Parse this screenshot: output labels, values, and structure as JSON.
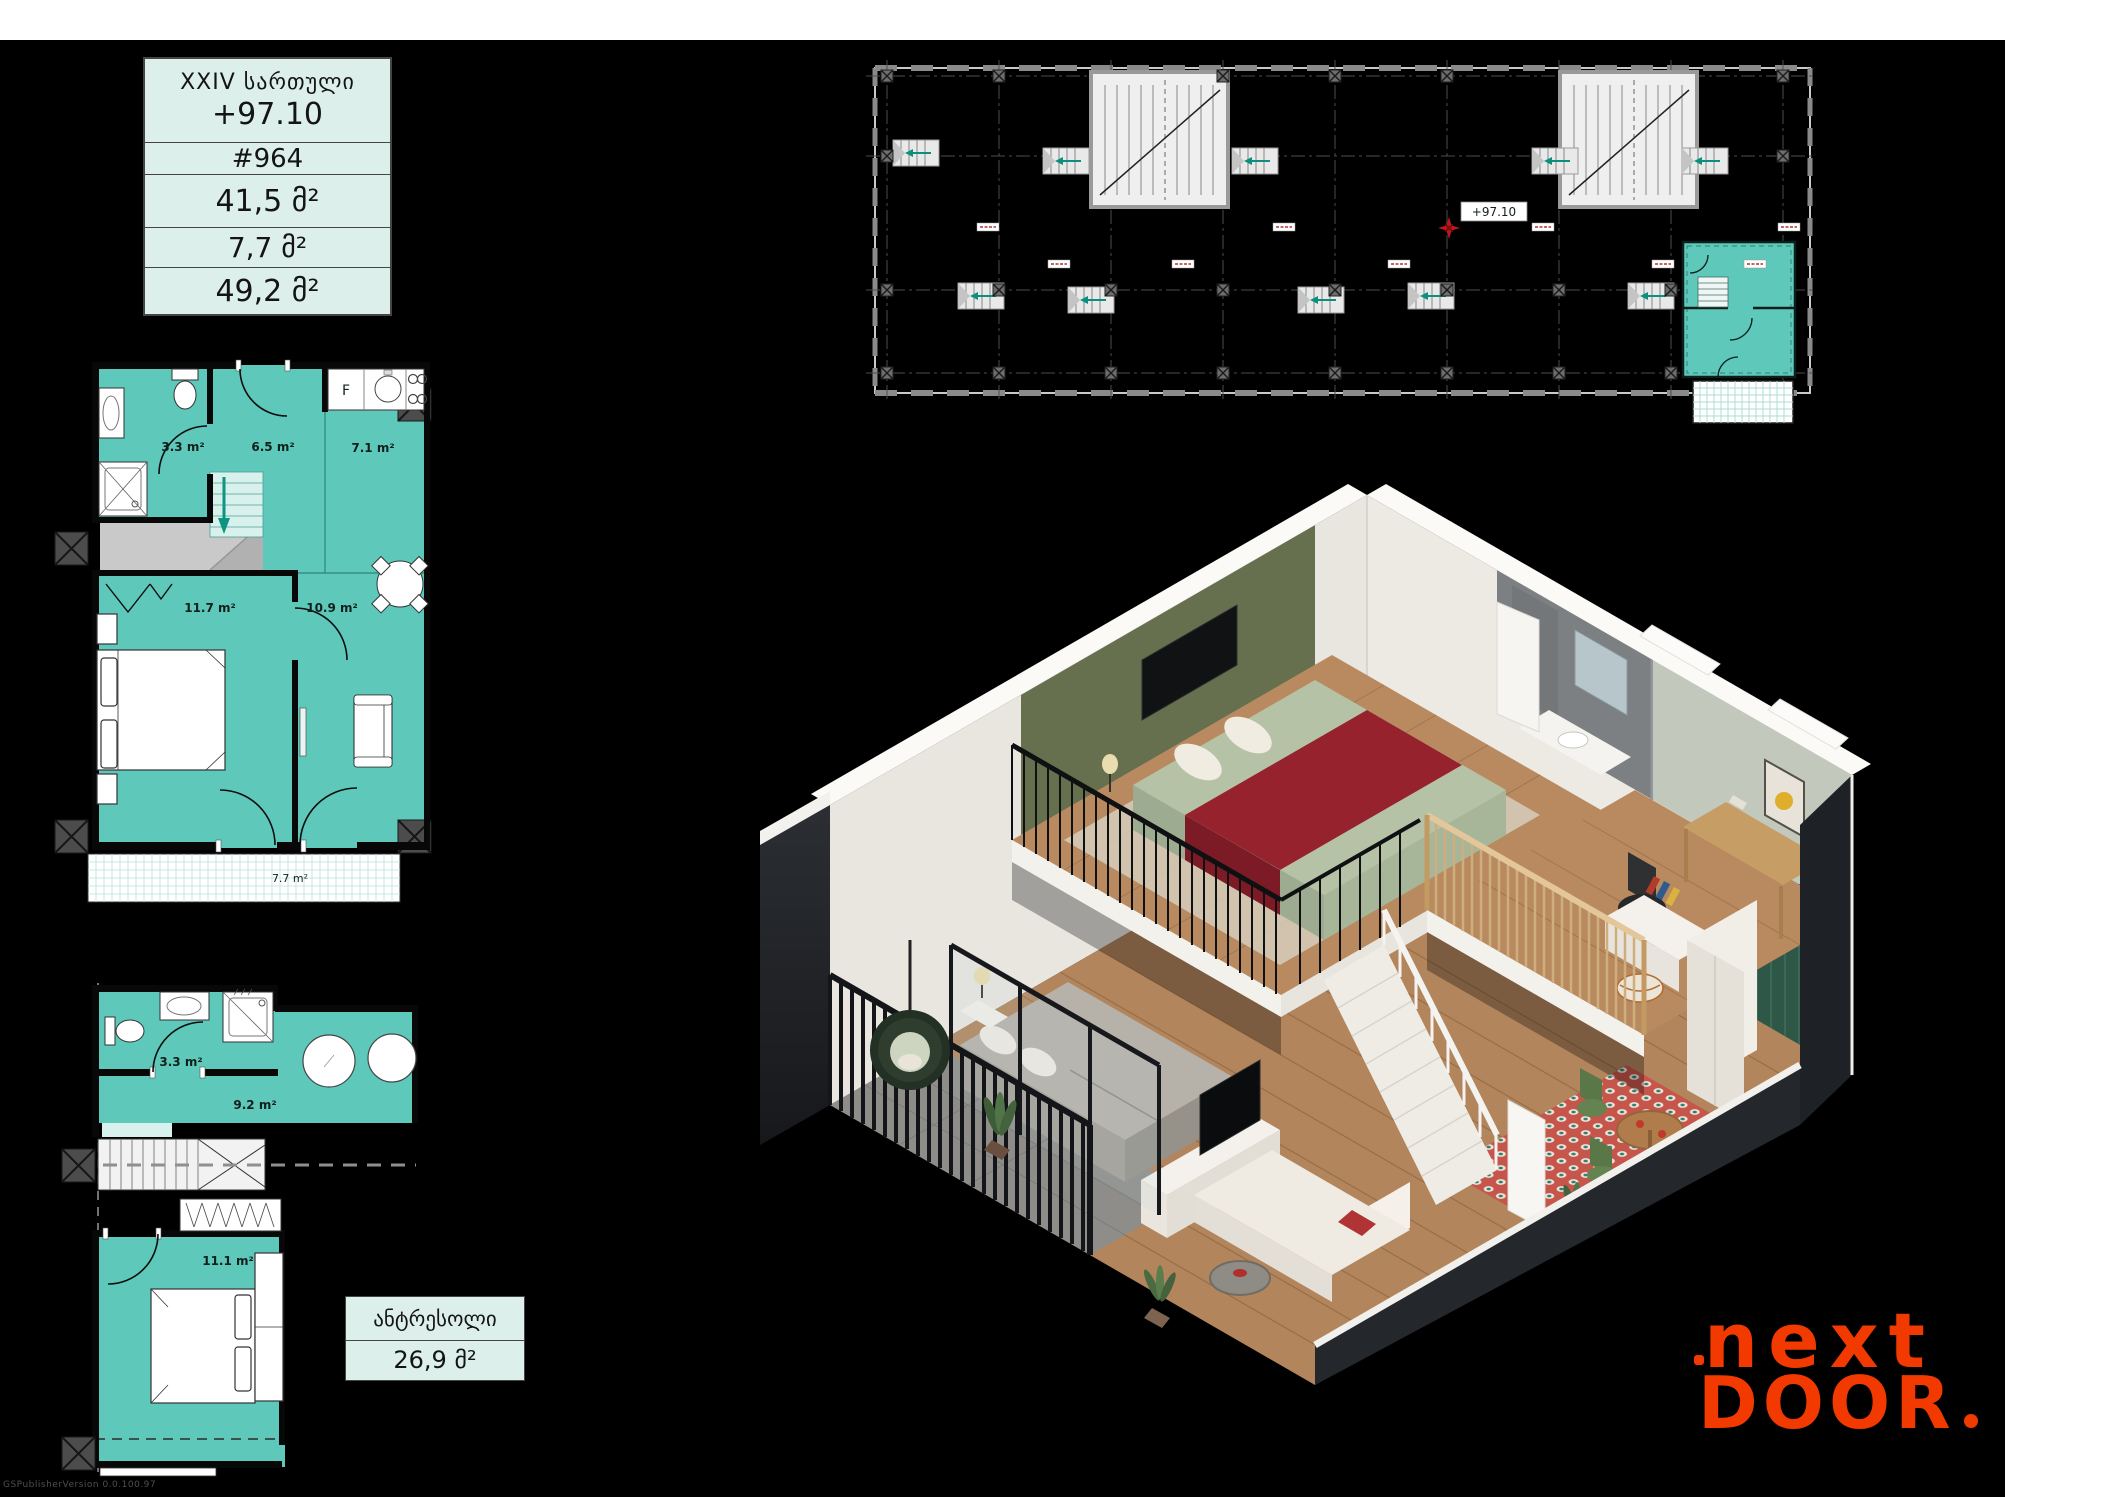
{
  "info_table": {
    "floor_label": "XXIV სართული",
    "elevation": "+97.10",
    "unit_number": "#964",
    "area_main": "41,5 მ²",
    "area_balcony": "7,7 მ²",
    "area_total": "49,2 მ²"
  },
  "key_plan": {
    "marker_label": "+97.10"
  },
  "upper_plan": {
    "rooms": {
      "bathroom": "3.3 m²",
      "hall": "6.5 m²",
      "kitchen": "7.1 m²",
      "bedroom": "11.7 m²",
      "living": "10.9 m²",
      "balcony": "7.7 m²"
    },
    "fridge_label": "F"
  },
  "lower_plan": {
    "rooms": {
      "bathroom": "3.3 m²",
      "hall": "9.2 m²",
      "bedroom": "11.1 m²"
    }
  },
  "mezzanine_box": {
    "title": "ანტრესოლი",
    "area": "26,9 მ²"
  },
  "logo": {
    "line1": "next",
    "line2": "DOOR"
  },
  "watermark": "GSPublisherVersion 0.0.100.97",
  "colors": {
    "teal": "#5EC8BB",
    "mint": "#DCEFEB",
    "logo_orange": "#F23A00",
    "marker_red": "#C3161C"
  }
}
